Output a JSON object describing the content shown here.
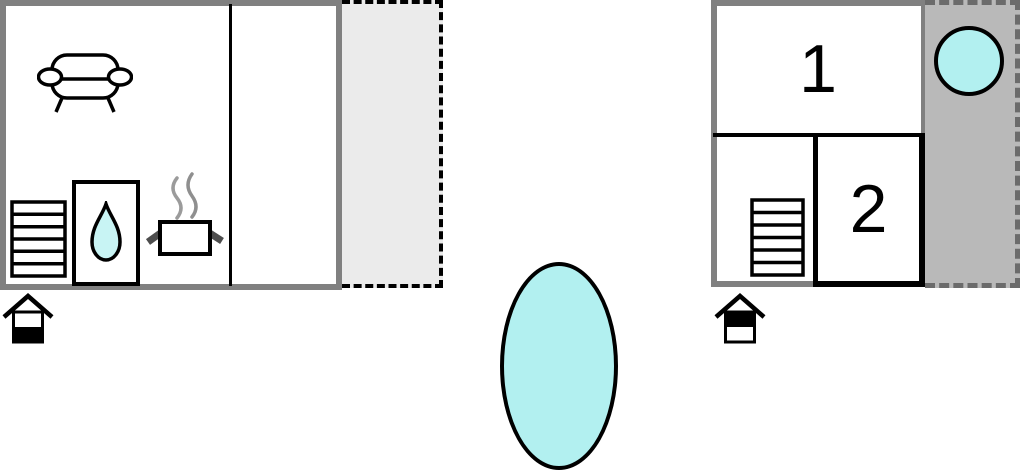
{
  "colors": {
    "wall_gray": "#808080",
    "interior_wall_black": "#000000",
    "water_cyan": "#b2f0f0",
    "terrace_light_gray": "#ebebeb",
    "terrace_dark_gray": "#b9b9b9",
    "terrace_dark_dash": "#6b6b6b",
    "steam_gray": "#999999"
  },
  "left_unit": {
    "icons": [
      "sofa-icon",
      "stairs-icon",
      "shower-water-drop-icon",
      "cooking-pot-steam-icon"
    ],
    "terrace": {
      "style": "light-gray-dashed"
    },
    "floor_indicator": "lower-floor-highlighted"
  },
  "right_unit": {
    "rooms": [
      {
        "label": "1"
      },
      {
        "label": "2"
      }
    ],
    "icons": [
      "stairs-icon",
      "hot-tub-circle-icon"
    ],
    "terrace": {
      "style": "dark-gray-dashed"
    },
    "floor_indicator": "upper-floor-highlighted"
  },
  "pool": {
    "shape": "ellipse",
    "fill": "#b2f0f0"
  }
}
